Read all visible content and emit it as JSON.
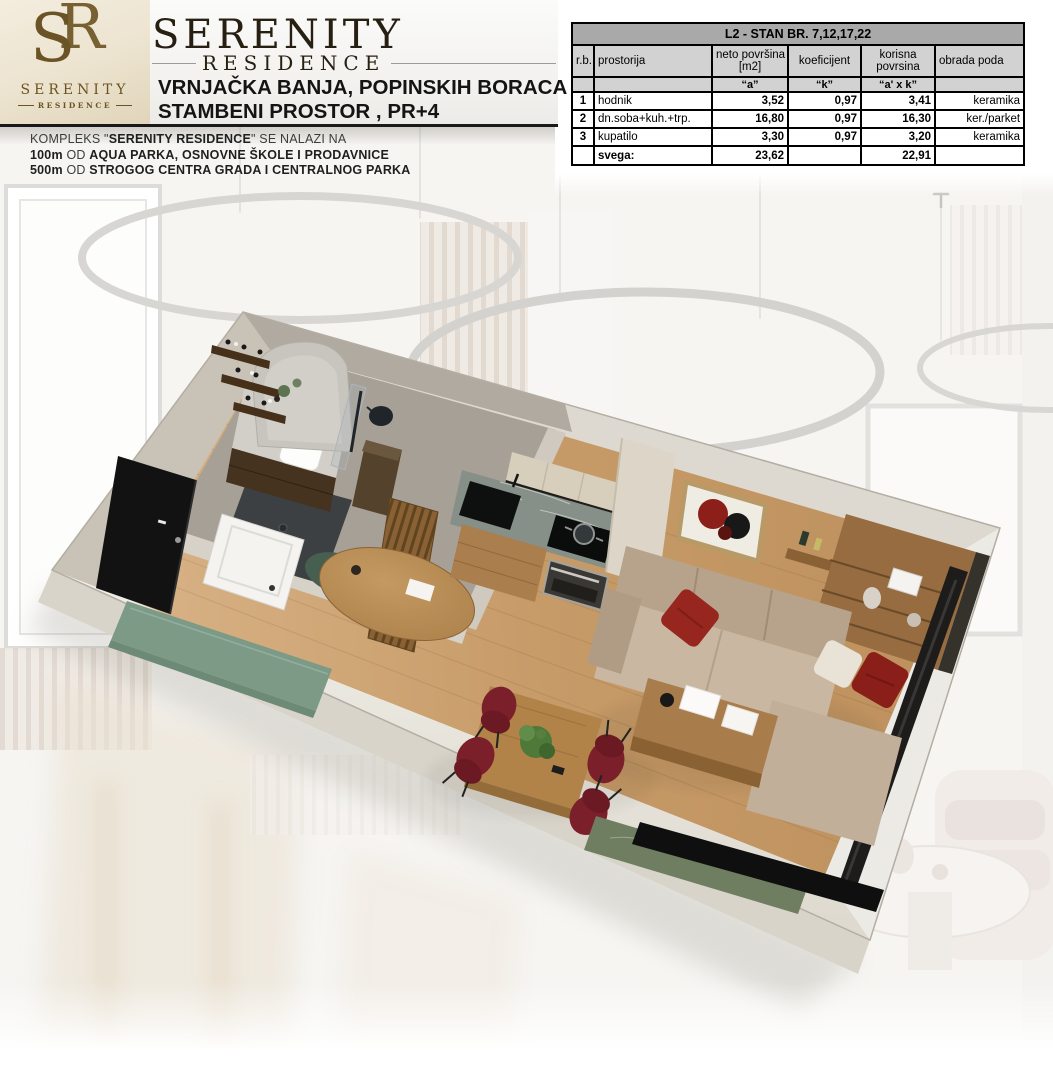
{
  "logo": {
    "monogram_s": "S",
    "monogram_r": "R",
    "name": "SERENITY",
    "subtitle": "RESIDENCE"
  },
  "header": {
    "title": "SERENITY",
    "subtitle": "RESIDENCE",
    "address_line": "VRNJAČKA BANJA, POPINSKIH BORACA",
    "property_line": "STAMBENI PROSTOR , PR+4"
  },
  "location": {
    "line1_pre": "KOMPLEKS \"",
    "line1_bold": "SERENITY RESIDENCE",
    "line1_post": "\" SE NALAZI NA",
    "line2_bold1": "100m",
    "line2_mid": " OD ",
    "line2_bold2": "AQUA PARKA, OSNOVNE ŠKOLE I PRODAVNICE",
    "line3_bold1": "500m",
    "line3_mid": " OD ",
    "line3_bold2": "STROGOG CENTRA GRADA I CENTRALNOG PARKA"
  },
  "table": {
    "title": "L2 - STAN BR. 7,12,17,22",
    "col_headers": {
      "rb": "r.b.",
      "room": "prostorija",
      "net_line1": "neto površina",
      "net_line2": "[m2]",
      "coef": "koeficijent",
      "useful_line1": "korisna",
      "useful_line2": "povrsina",
      "floor": "obrada poda"
    },
    "sub_headers": {
      "net": "“a”",
      "coef": "“k”",
      "useful": "“a' x k”"
    },
    "rows": [
      {
        "rb": "1",
        "room": "hodnik",
        "net": "3,52",
        "coef": "0,97",
        "useful": "3,41",
        "floor": "keramika"
      },
      {
        "rb": "2",
        "room": "dn.soba+kuh.+trp.",
        "net": "16,80",
        "coef": "0,97",
        "useful": "16,30",
        "floor": "ker./parket"
      },
      {
        "rb": "3",
        "room": "kupatilo",
        "net": "3,30",
        "coef": "0,97",
        "useful": "3,20",
        "floor": "keramika"
      }
    ],
    "total": {
      "label": "svega:",
      "net": "23,62",
      "useful": "22,91"
    }
  },
  "colors": {
    "logo_bronze": "#6f572a",
    "accent_red": "#8e2420",
    "bench_green": "#7d9a87",
    "oak_floor": "#c69a67",
    "marble_counter": "#868f88",
    "table_title_gray": "#a9a9a9",
    "table_header_gray": "#d2d2d2"
  }
}
